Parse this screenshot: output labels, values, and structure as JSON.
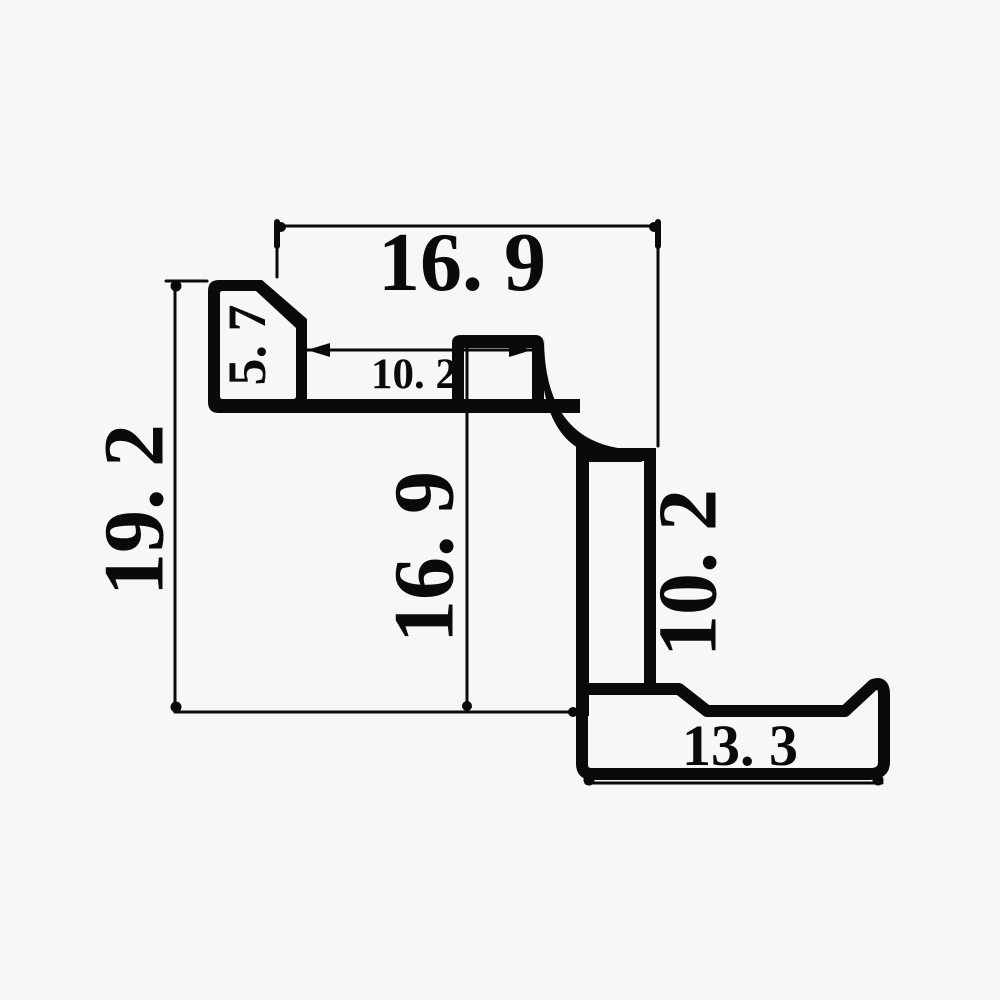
{
  "drawing": {
    "kind": "extrusion-profile-cross-section",
    "background_color": "#f7f7f6",
    "line_color": "#0a0a0a",
    "labels": {
      "top_width": {
        "text": "16. 9",
        "value": 16.9,
        "orientation": "horizontal",
        "position": "top"
      },
      "pocket_height": {
        "text": "5. 7",
        "value": 5.7,
        "orientation": "vertical",
        "position": "upper-left-pocket"
      },
      "slot_width": {
        "text": "10. 2",
        "value": 10.2,
        "orientation": "horizontal",
        "position": "upper-middle"
      },
      "overall_height": {
        "text": "19. 2",
        "value": 19.2,
        "orientation": "vertical",
        "position": "left"
      },
      "mid_height": {
        "text": "16. 9",
        "value": 16.9,
        "orientation": "vertical",
        "position": "middle"
      },
      "web_height": {
        "text": "10. 2",
        "value": 10.2,
        "orientation": "vertical",
        "position": "right"
      },
      "flange_width": {
        "text": "13. 3",
        "value": 13.3,
        "orientation": "horizontal",
        "position": "bottom"
      }
    }
  }
}
